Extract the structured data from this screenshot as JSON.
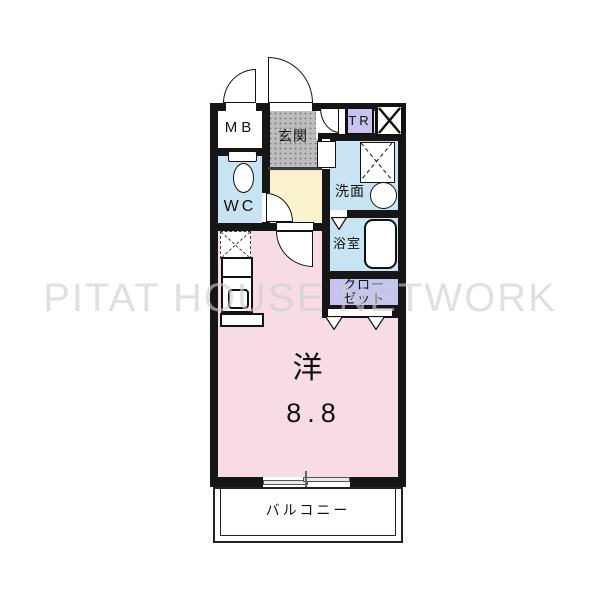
{
  "watermark": {
    "text": "PITAT HOUSE NETWORK",
    "color": "#dcdcdc"
  },
  "unit": {
    "meter_box": {
      "label": "MB"
    },
    "entrance": {
      "label": "玄関"
    },
    "trunk_room": {
      "label": "TR"
    },
    "toilet_room": {
      "label": "WC"
    },
    "washroom": {
      "label": "洗面"
    },
    "bathroom": {
      "label": "浴室"
    },
    "closet": {
      "label_line1": "クロー",
      "label_line2": "ゼット"
    },
    "main_room": {
      "type_label": "洋",
      "size_label": "8.8"
    },
    "balcony": {
      "label": "バルコニー"
    }
  },
  "colors": {
    "wall": "#161616",
    "main_room_pink": "#f8dce5",
    "hall_yellow": "#faf3cd",
    "wet_area_blue": "#c8e3f2",
    "closet_lavender": "#c6c3ef",
    "entrance_gray": "#bdbdbd",
    "watermark_gray": "#dcdcdc"
  }
}
